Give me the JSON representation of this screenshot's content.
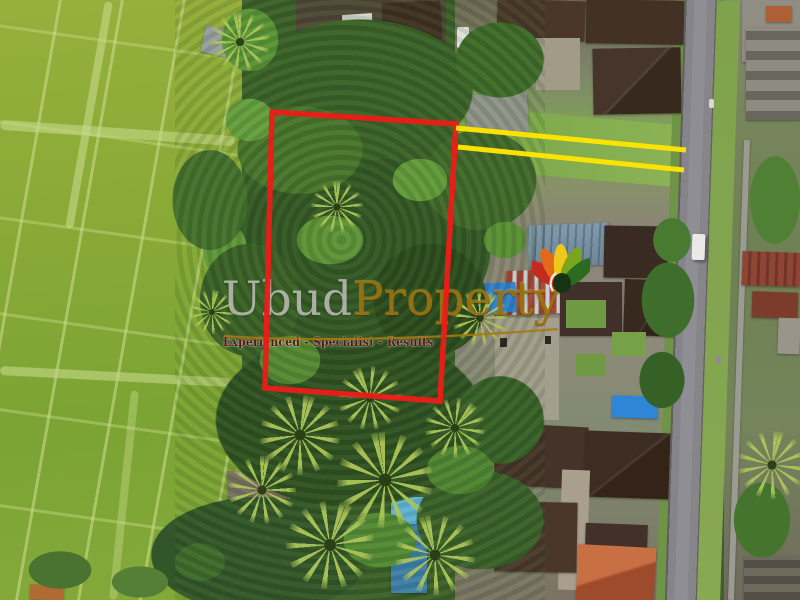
{
  "watermark": {
    "brand_primary": "Ubud",
    "brand_secondary": "Property",
    "tagline": "Experienced - Specialist - Results",
    "brand_primary_color": "#bcbeb6",
    "brand_secondary_color": "#9a7110",
    "tagline_color": "#571510",
    "underline_color": "#a5790f"
  },
  "logo": {
    "name": "ubud-property-leaf-logo",
    "petal_colors": [
      "#c42a1e",
      "#e4671c",
      "#eec81b",
      "#7aa61e",
      "#2c6a20"
    ],
    "center_color": "#163313",
    "accent_color": "#ffffff"
  },
  "overlays": {
    "plot_boundary": {
      "color": "#ea1d18",
      "points": "272,112 456,124 440,401 265,388",
      "stroke_width": "5.5"
    },
    "access_lines": {
      "color": "#ffe500",
      "line1_points": "456,128 686,150",
      "line2_points": "458,147 684,170",
      "stroke_width": "5"
    }
  },
  "scene_palette": {
    "rice_field_green": "#88a936",
    "tree_canopy_green": "#345726",
    "palm_frond_green": "#acc458",
    "road_gray": "#8e8e94",
    "roof_dark_brown": "#41302a",
    "roof_orange": "#b55a36",
    "roof_metal_white": "#cdd0cb",
    "roof_rust_red": "#8f4534",
    "tarp_blue": "#2f86d6",
    "pool_blue": "#62b5dc"
  }
}
